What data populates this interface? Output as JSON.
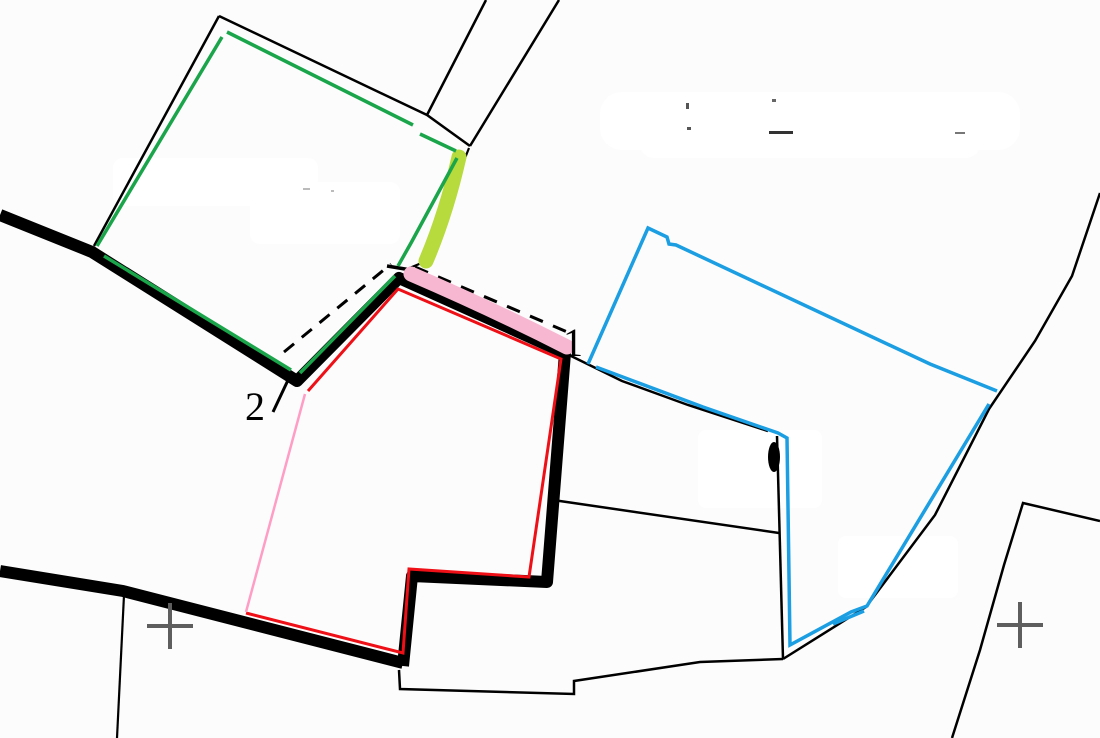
{
  "canvas": {
    "width": 1100,
    "height": 738,
    "background": "#fcfcfc"
  },
  "palette": {
    "boundary_black": "#000000",
    "parcel_green": "#1aa54b",
    "parcel_red": "#ee1016",
    "parcel_blue": "#1b9ee2",
    "boundary_pink": "#ff9dc5",
    "highlight_pink": "#f8b7d1",
    "highlight_chartreuse": "#b7da3c",
    "grid_cross_gray": "#5e5e5e"
  },
  "labels": [
    {
      "name": "point-label-1",
      "text": "1",
      "x": 563,
      "y": 356,
      "font_size": 40,
      "color": "#000000"
    },
    {
      "name": "point-label-2",
      "text": "2",
      "x": 245,
      "y": 420,
      "font_size": 40,
      "color": "#000000"
    }
  ],
  "smudges": [
    {
      "x": 600,
      "y": 92,
      "w": 420,
      "h": 58,
      "rx": 22
    },
    {
      "x": 640,
      "y": 128,
      "w": 340,
      "h": 30,
      "rx": 14
    },
    {
      "x": 113,
      "y": 158,
      "w": 205,
      "h": 48,
      "rx": 10
    },
    {
      "x": 250,
      "y": 182,
      "w": 150,
      "h": 62,
      "rx": 10
    },
    {
      "x": 698,
      "y": 430,
      "w": 124,
      "h": 78,
      "rx": 8
    },
    {
      "x": 838,
      "y": 536,
      "w": 120,
      "h": 62,
      "rx": 8
    }
  ],
  "specks": [
    {
      "x": 686,
      "y": 103,
      "w": 3,
      "h": 6,
      "c": "#555555"
    },
    {
      "x": 772,
      "y": 99,
      "w": 4,
      "h": 3,
      "c": "#666666"
    },
    {
      "x": 687,
      "y": 127,
      "w": 4,
      "h": 3,
      "c": "#555555"
    },
    {
      "x": 769,
      "y": 131,
      "w": 24,
      "h": 3,
      "c": "#333333"
    },
    {
      "x": 955,
      "y": 132,
      "w": 10,
      "h": 2,
      "c": "#777777"
    },
    {
      "x": 303,
      "y": 188,
      "w": 7,
      "h": 2,
      "c": "#bbbbbb"
    },
    {
      "x": 331,
      "y": 190,
      "w": 3,
      "h": 2,
      "c": "#bbbbbb"
    }
  ],
  "strokes": [
    {
      "name": "green-parcel-black-top-edge",
      "type": "polyline",
      "points": [
        [
          219,
          16
        ],
        [
          427,
          115
        ],
        [
          470,
          146
        ]
      ],
      "color": "#000000",
      "width": 2.5
    },
    {
      "name": "green-parcel-black-left-edge",
      "type": "polyline",
      "points": [
        [
          219,
          16
        ],
        [
          94,
          246
        ]
      ],
      "color": "#000000",
      "width": 2.5
    },
    {
      "name": "lane-boundary-west",
      "type": "polyline",
      "points": [
        [
          486,
          0
        ],
        [
          427,
          115
        ]
      ],
      "color": "#000000",
      "width": 2.5
    },
    {
      "name": "lane-boundary-east",
      "type": "polyline",
      "points": [
        [
          559,
          0
        ],
        [
          470,
          146
        ]
      ],
      "color": "#000000",
      "width": 2.5
    },
    {
      "name": "boundary-under-chartreuse",
      "type": "polyline",
      "points": [
        [
          469,
          148
        ],
        [
          424,
          262
        ],
        [
          407,
          269
        ]
      ],
      "color": "#000000",
      "width": 2.2
    },
    {
      "name": "boundary-curve-east-of-red",
      "type": "polyline",
      "points": [
        [
          567,
          354
        ],
        [
          622,
          381
        ],
        [
          688,
          405
        ],
        [
          768,
          431
        ]
      ],
      "color": "#000000",
      "width": 2.5
    },
    {
      "name": "boundary-vertical-mid",
      "type": "polyline",
      "points": [
        [
          777,
          436
        ],
        [
          783,
          659
        ]
      ],
      "color": "#000000",
      "width": 2.5
    },
    {
      "name": "boundary-horizontal-mid",
      "type": "polyline",
      "points": [
        [
          553,
          500
        ],
        [
          779,
          533
        ]
      ],
      "color": "#000000",
      "width": 2.5
    },
    {
      "name": "boundary-bottom",
      "type": "polyline",
      "points": [
        [
          399,
          670
        ],
        [
          400,
          689
        ],
        [
          574,
          694
        ],
        [
          574,
          681
        ],
        [
          700,
          662
        ],
        [
          783,
          659
        ]
      ],
      "color": "#000000",
      "width": 2.5
    },
    {
      "name": "boundary-long-northeast",
      "type": "polyline",
      "points": [
        [
          783,
          659
        ],
        [
          866,
          607
        ],
        [
          935,
          515
        ],
        [
          989,
          409
        ],
        [
          1035,
          341
        ],
        [
          1072,
          276
        ],
        [
          1100,
          193
        ]
      ],
      "color": "#000000",
      "width": 2.5
    },
    {
      "name": "boundary-v-line-southeast",
      "type": "polyline",
      "points": [
        [
          1100,
          521
        ],
        [
          1023,
          503
        ],
        [
          1004,
          565
        ],
        [
          980,
          650
        ],
        [
          952,
          738
        ]
      ],
      "color": "#000000",
      "width": 2.5
    },
    {
      "name": "boundary-thin-vertical-left",
      "type": "polyline",
      "points": [
        [
          124,
          595
        ],
        [
          117,
          738
        ]
      ],
      "color": "#000000",
      "width": 2.2
    },
    {
      "name": "label-2-leader-line",
      "type": "polyline",
      "points": [
        [
          273,
          412
        ],
        [
          289,
          378
        ]
      ],
      "color": "#000000",
      "width": 3
    },
    {
      "name": "survey-dashed-line-west",
      "type": "polyline",
      "points": [
        [
          284,
          352
        ],
        [
          391,
          264
        ]
      ],
      "color": "#000000",
      "width": 3,
      "dash": "13 10"
    },
    {
      "name": "survey-dashed-line-east",
      "type": "polyline",
      "points": [
        [
          415,
          267
        ],
        [
          572,
          334
        ]
      ],
      "color": "#000000",
      "width": 3,
      "dash": "14 11"
    },
    {
      "name": "road-thick-main",
      "type": "polyline",
      "points": [
        [
          0,
          215
        ],
        [
          92,
          252
        ],
        [
          297,
          381
        ],
        [
          399,
          278
        ],
        [
          565,
          353
        ],
        [
          547,
          582
        ],
        [
          412,
          576
        ],
        [
          403,
          666
        ]
      ],
      "color": "#000000",
      "width": 12,
      "join": "round"
    },
    {
      "name": "road-thick-south",
      "type": "polyline",
      "points": [
        [
          0,
          571
        ],
        [
          123,
          591
        ],
        [
          403,
          663
        ]
      ],
      "color": "#000000",
      "width": 12,
      "join": "round"
    },
    {
      "name": "junction-tick",
      "type": "polyline",
      "points": [
        [
          387,
          266
        ],
        [
          417,
          271
        ]
      ],
      "color": "#000000",
      "width": 3.5
    },
    {
      "name": "highlight-pink-stroke",
      "type": "path",
      "d": "M 411,274 Q 490,308 567,347",
      "color": "#f8b7d1",
      "width": 15,
      "cap": "round"
    },
    {
      "name": "highlight-chartreuse-stroke",
      "type": "path",
      "d": "M 459,157 Q 446,214 426,261",
      "color": "#b7da3c",
      "width": 15,
      "cap": "round"
    },
    {
      "name": "green-parcel-top",
      "type": "polyline",
      "points": [
        [
          227,
          32
        ],
        [
          413,
          125
        ]
      ],
      "color": "#1aa54b",
      "width": 3.5
    },
    {
      "name": "green-parcel-top-right",
      "type": "polyline",
      "points": [
        [
          420,
          134
        ],
        [
          456,
          151
        ]
      ],
      "color": "#1aa54b",
      "width": 3.5
    },
    {
      "name": "green-parcel-right",
      "type": "polyline",
      "points": [
        [
          457,
          158
        ],
        [
          411,
          243
        ],
        [
          398,
          266
        ]
      ],
      "color": "#1aa54b",
      "width": 3.5
    },
    {
      "name": "green-parcel-southeast",
      "type": "polyline",
      "points": [
        [
          395,
          276
        ],
        [
          300,
          373
        ]
      ],
      "color": "#1aa54b",
      "width": 3.5
    },
    {
      "name": "green-parcel-bottom",
      "type": "polyline",
      "points": [
        [
          104,
          256
        ],
        [
          291,
          370
        ]
      ],
      "color": "#1aa54b",
      "width": 3.5
    },
    {
      "name": "green-parcel-left",
      "type": "polyline",
      "points": [
        [
          222,
          37
        ],
        [
          97,
          246
        ]
      ],
      "color": "#1aa54b",
      "width": 3.5
    },
    {
      "name": "red-parcel-outline",
      "type": "polyline",
      "points": [
        [
          308,
          391
        ],
        [
          398,
          289
        ],
        [
          561,
          359
        ],
        [
          529,
          577
        ],
        [
          409,
          569
        ],
        [
          403,
          653
        ],
        [
          246,
          613
        ]
      ],
      "color": "#ee1016",
      "width": 3
    },
    {
      "name": "pink-boundary-segment",
      "type": "polyline",
      "points": [
        [
          246,
          612
        ],
        [
          305,
          394
        ]
      ],
      "color": "#ff9dc5",
      "width": 2.5
    },
    {
      "name": "blue-parcel-north-edge",
      "type": "polyline",
      "points": [
        [
          588,
          364
        ],
        [
          648,
          228
        ],
        [
          667,
          237
        ],
        [
          669,
          244
        ],
        [
          676,
          245
        ],
        [
          930,
          364
        ],
        [
          997,
          391
        ]
      ],
      "color": "#1b9ee2",
      "width": 3.5
    },
    {
      "name": "blue-parcel-south-edge",
      "type": "polyline",
      "points": [
        [
          989,
          404
        ],
        [
          867,
          606
        ],
        [
          851,
          612
        ],
        [
          790,
          645
        ],
        [
          787,
          438
        ],
        [
          778,
          433
        ],
        [
          703,
          407
        ],
        [
          596,
          367
        ]
      ],
      "color": "#1b9ee2",
      "width": 3.5
    },
    {
      "name": "blue-overlap-stroke",
      "type": "polyline",
      "points": [
        [
          833,
          624
        ],
        [
          864,
          611
        ]
      ],
      "color": "#1b9ee2",
      "width": 3.5
    },
    {
      "name": "tree-blob-mark",
      "type": "ellipse",
      "cx": 774,
      "cy": 457,
      "rx": 6,
      "ry": 15,
      "fill": "#000000"
    },
    {
      "name": "grid-cross-west",
      "type": "cross",
      "cx": 170,
      "cy": 626,
      "arm": 23,
      "color": "#5e5e5e",
      "width": 4
    },
    {
      "name": "grid-cross-east",
      "type": "cross",
      "cx": 1020,
      "cy": 625,
      "arm": 23,
      "color": "#5e5e5e",
      "width": 4
    }
  ]
}
